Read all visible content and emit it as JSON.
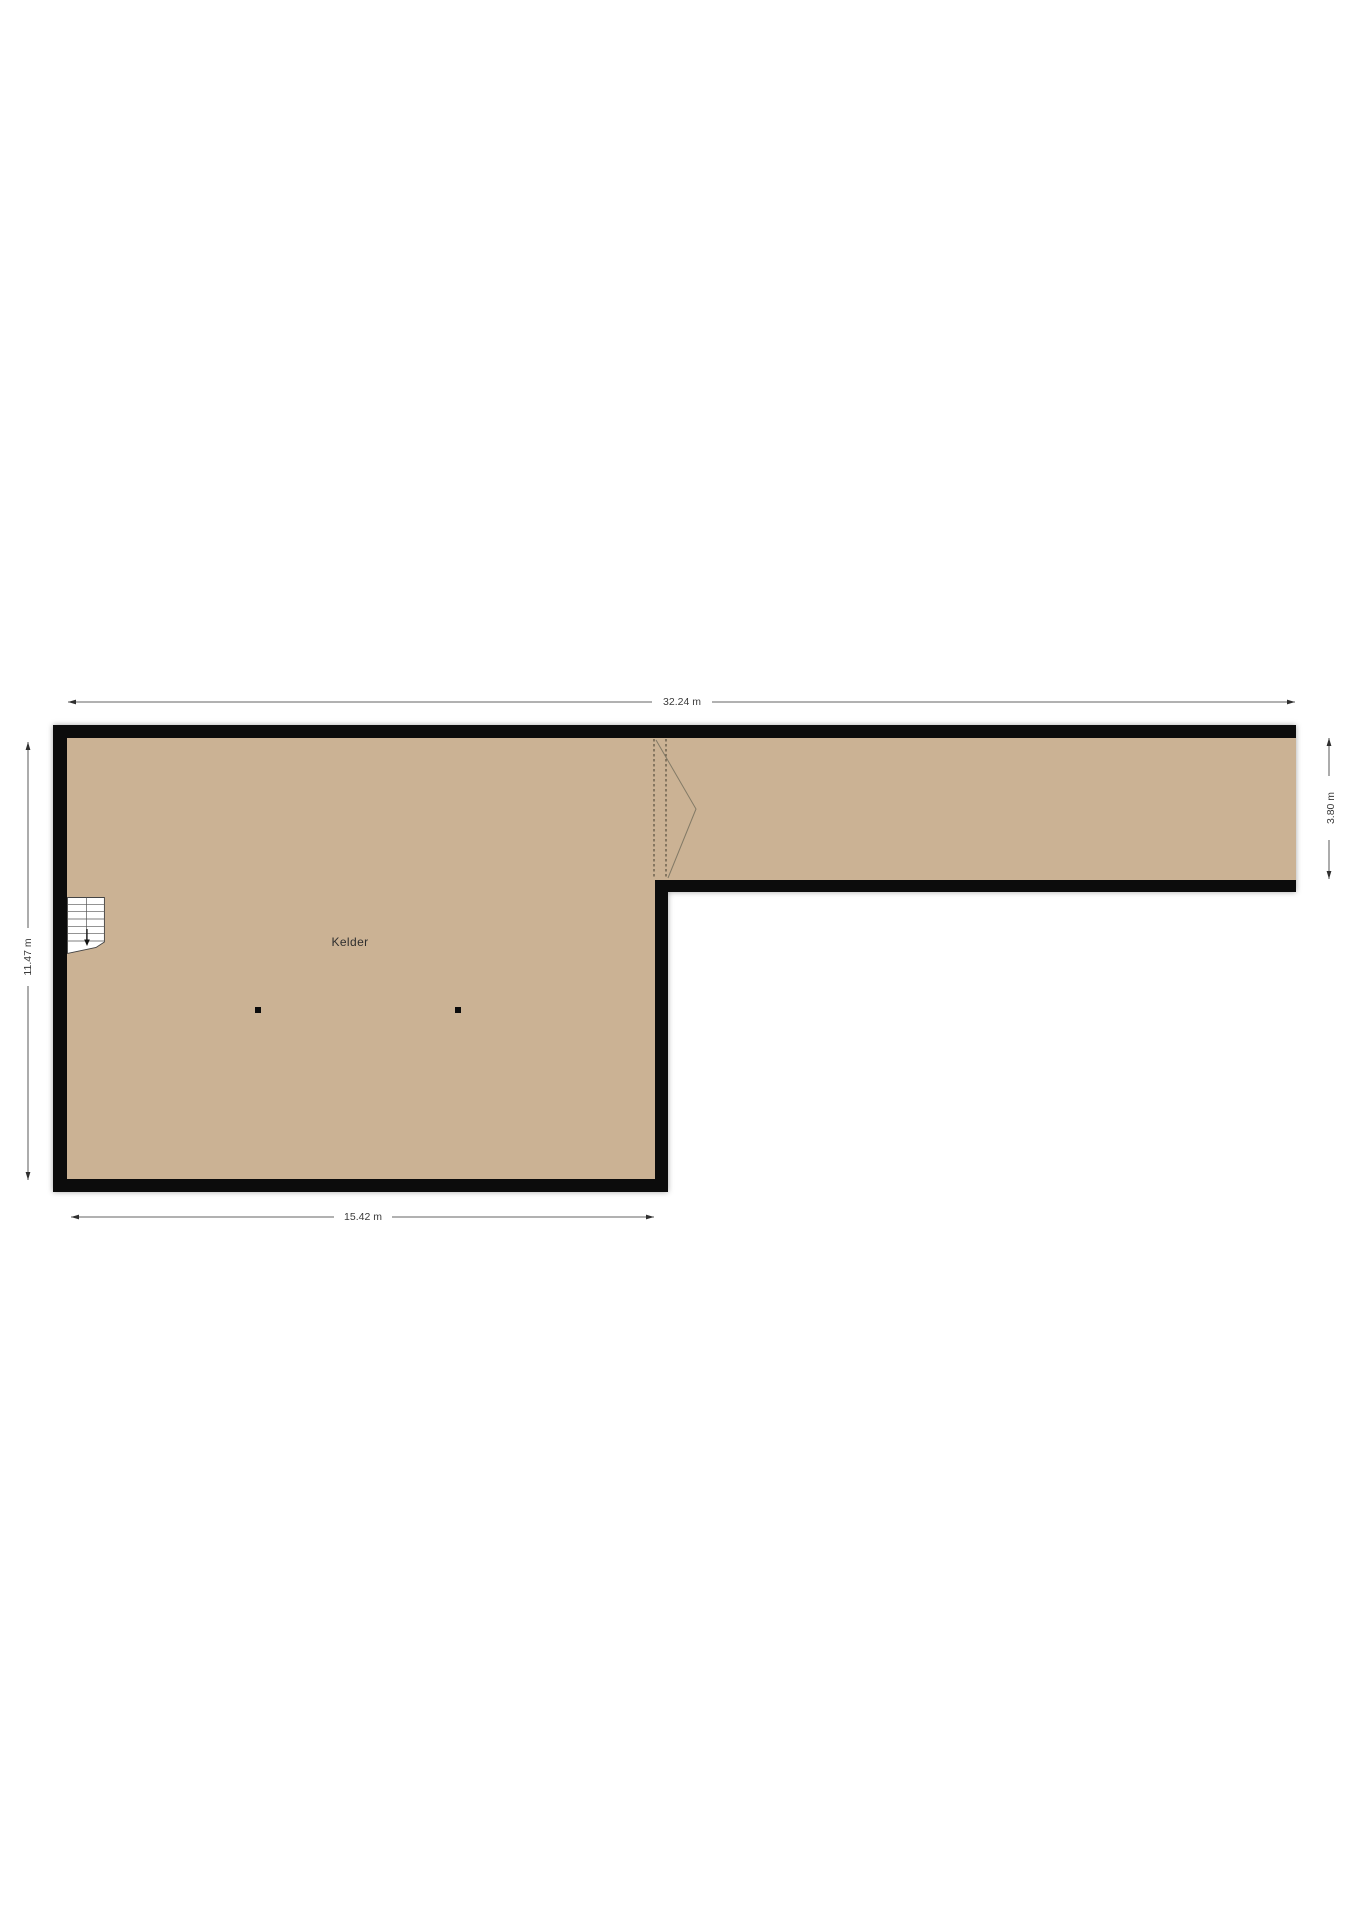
{
  "floorplan": {
    "room": {
      "label": "Kelder"
    },
    "dimensions": {
      "width_total": "32.24 m",
      "width_room": "15.42 m",
      "height_room": "11.47 m",
      "height_corridor": "3.80 m"
    },
    "colors": {
      "floor": "#cbb294",
      "wall": "#0c0c0c",
      "dimension_text": "#3a3a3a"
    }
  }
}
